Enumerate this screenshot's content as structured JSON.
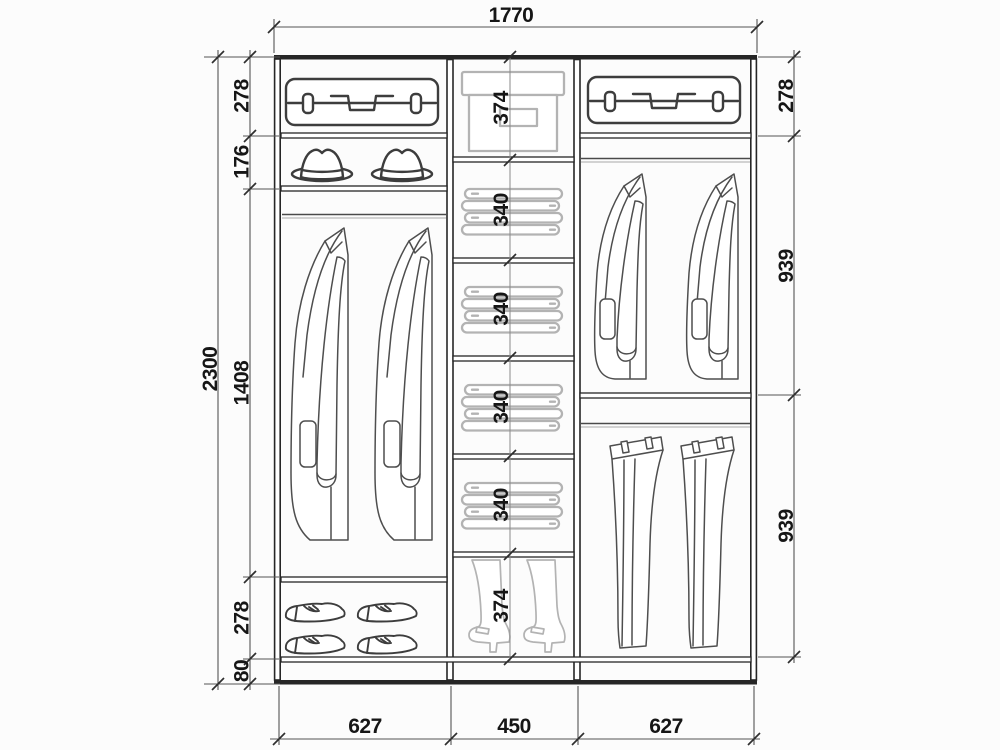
{
  "colors": {
    "background": "#fcfcfc",
    "frame": "#262626",
    "item_dark": "#4e4e4e",
    "item_light": "#b3b3b3",
    "dim_line": "#555555",
    "text": "#161616"
  },
  "wardrobe": {
    "overall_width": "1770",
    "overall_height": "2300",
    "left_sections": {
      "suitcase_shelf": "278",
      "hat_shelf": "176",
      "hanging": "1408",
      "shoe_shelf": "278",
      "plinth": "80"
    },
    "middle_sections": {
      "box_shelf": "374",
      "shelf_1": "340",
      "shelf_2": "340",
      "shelf_3": "340",
      "shelf_4": "340",
      "boots_shelf": "374"
    },
    "right_sections": {
      "suitcase_shelf": "278",
      "jackets": "939",
      "trousers": "939"
    },
    "bottom_widths": {
      "left": "627",
      "middle": "450",
      "right": "627"
    },
    "icons": {
      "suitcase": "suitcase-icon",
      "hat": "fedora-hat-icon",
      "coat": "hanging-coat-icon",
      "jacket": "hanging-jacket-icon",
      "trousers": "hanging-trousers-icon",
      "folded_clothes": "folded-clothes-icon",
      "box": "storage-box-icon",
      "boot": "high-boot-icon",
      "shoe": "shoe-icon"
    }
  }
}
